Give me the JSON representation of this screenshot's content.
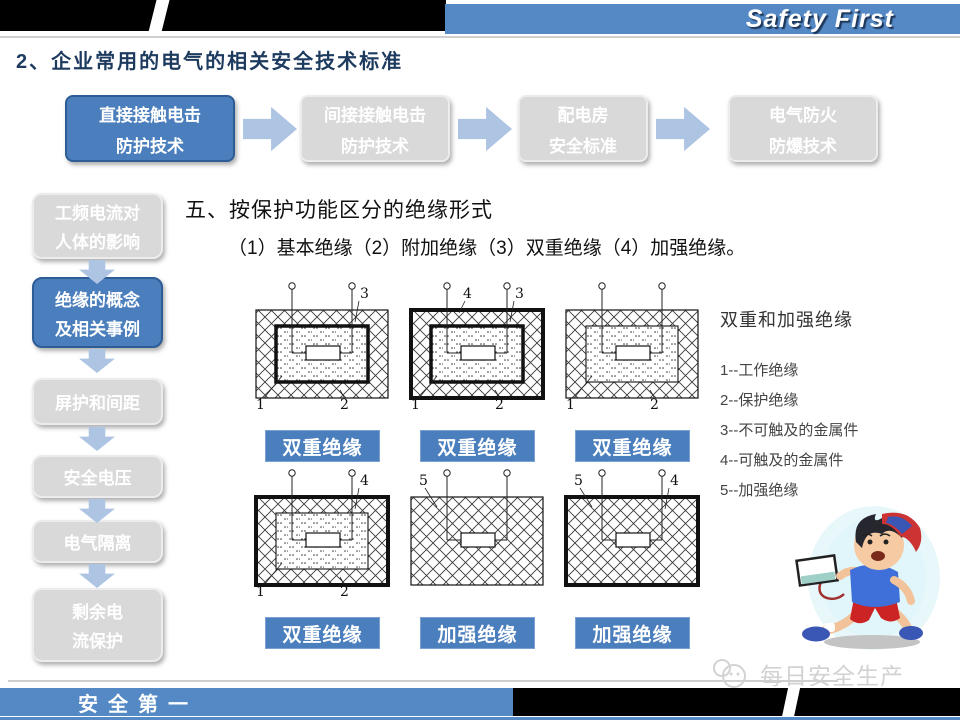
{
  "banner": {
    "brand": "Safety First"
  },
  "page_title": "2、企业常用的电气的相关安全技术标准",
  "flowchart": {
    "items": [
      {
        "lines": [
          "直接接触电击",
          "防护技术"
        ],
        "active": true
      },
      {
        "lines": [
          "间接接触电击",
          "防护技术"
        ],
        "active": false
      },
      {
        "lines": [
          "配电房",
          "安全标准"
        ],
        "active": false
      },
      {
        "lines": [
          "电气防火",
          "防爆技术"
        ],
        "active": false
      }
    ]
  },
  "sidebar": {
    "items": [
      {
        "lines": [
          "工频电流对",
          "人体的影响"
        ],
        "active": false
      },
      {
        "lines": [
          "绝缘的概念",
          "及相关事例"
        ],
        "active": true
      },
      {
        "lines": [
          "屏护和间距"
        ],
        "active": false
      },
      {
        "lines": [
          "安全电压"
        ],
        "active": false
      },
      {
        "lines": [
          "电气隔离"
        ],
        "active": false
      },
      {
        "lines": [
          "剩余电",
          "流保护"
        ],
        "active": false
      }
    ]
  },
  "content": {
    "heading": "五、按保护功能区分的绝缘形式",
    "subheading": "（1）基本绝缘（2）附加绝缘（3）双重绝缘（4）加强绝缘。",
    "legend": {
      "title": "双重和加强绝缘",
      "items": [
        "1--工作绝缘",
        "2--保护绝缘",
        "3--不可触及的金属件",
        "4--可触及的金属件",
        "5--加强绝缘"
      ]
    },
    "diagrams": [
      {
        "caption": "双重绝缘",
        "outer_thick": false,
        "inner": true,
        "inner_thick": true,
        "labels": [
          {
            "text": "3",
            "pos": "top-right"
          },
          {
            "text": "1",
            "pos": "bottom-left"
          },
          {
            "text": "2",
            "pos": "bottom-right"
          }
        ]
      },
      {
        "caption": "双重绝缘",
        "outer_thick": true,
        "inner": true,
        "inner_thick": true,
        "labels": [
          {
            "text": "4",
            "pos": "top-mid"
          },
          {
            "text": "3",
            "pos": "top-right"
          },
          {
            "text": "1",
            "pos": "bottom-left"
          },
          {
            "text": "2",
            "pos": "bottom-right"
          }
        ]
      },
      {
        "caption": "双重绝缘",
        "outer_thick": false,
        "inner": true,
        "inner_thick": false,
        "labels": [
          {
            "text": "1",
            "pos": "bottom-left"
          },
          {
            "text": "2",
            "pos": "bottom-right"
          }
        ]
      },
      {
        "caption": "双重绝缘",
        "outer_thick": true,
        "inner": true,
        "inner_thick": false,
        "labels": [
          {
            "text": "4",
            "pos": "top-right"
          },
          {
            "text": "1",
            "pos": "bottom-left"
          },
          {
            "text": "2",
            "pos": "bottom-right"
          }
        ]
      },
      {
        "caption": "加强绝缘",
        "outer_thick": false,
        "inner": false,
        "inner_thick": false,
        "labels": [
          {
            "text": "5",
            "pos": "top-left"
          }
        ]
      },
      {
        "caption": "加强绝缘",
        "outer_thick": true,
        "inner": false,
        "inner_thick": false,
        "labels": [
          {
            "text": "5",
            "pos": "top-left"
          },
          {
            "text": "4",
            "pos": "top-right"
          }
        ]
      }
    ]
  },
  "footer": {
    "slogan": "安全第一",
    "watermark": "每日安全生产"
  },
  "colors": {
    "accent_blue": "#4a7ebc",
    "banner_blue": "#5489c5",
    "inactive_gray": "#d9d9d9",
    "arrow_blue": "#aec4e3"
  }
}
